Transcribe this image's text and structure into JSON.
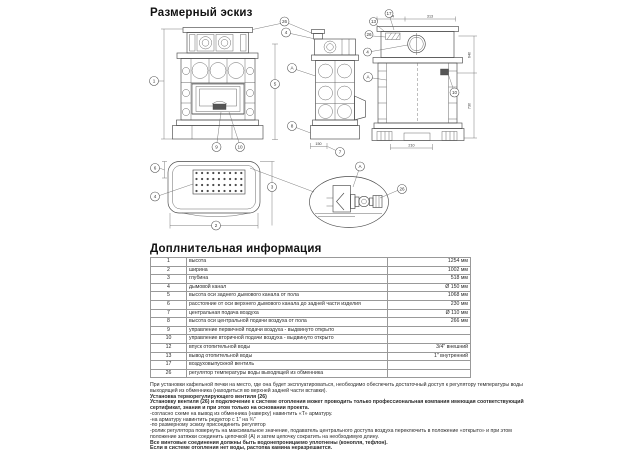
{
  "doc": {
    "drawing_title": "Размерный эскиз",
    "info_title": "Доплнительная информация"
  },
  "drawing": {
    "callouts": {
      "n1": "1",
      "n2": "2",
      "n3": "3",
      "n4": "4",
      "n5": "5",
      "n6": "6",
      "n7": "7",
      "n8": "8",
      "n9": "9",
      "n10": "10",
      "n13": "13",
      "n17": "17",
      "n26": "26",
      "a": "А"
    },
    "dimensions": {
      "rear_top_left": "204",
      "rear_top_right": "313",
      "rear_right_upper": "640",
      "rear_right_lower": "730",
      "side_bottom": "150",
      "rear_bottom": "210"
    }
  },
  "table": {
    "rows": [
      {
        "num": "1",
        "label": "высота",
        "value": "1254 мм"
      },
      {
        "num": "2",
        "label": "ширина",
        "value": "1002 мм"
      },
      {
        "num": "3",
        "label": "глубина",
        "value": "518 мм"
      },
      {
        "num": "4",
        "label": "дымовой канал",
        "value": "Ø 150 мм"
      },
      {
        "num": "5",
        "label": "высота оси заднего дымового канала от пола",
        "value": "1068 мм"
      },
      {
        "num": "6",
        "label": "расстояние от оси верхнего дымового канала до задней части изделия",
        "value": "230 мм"
      },
      {
        "num": "7",
        "label": "центральная подача воздуха",
        "value": "Ø 110 мм"
      },
      {
        "num": "8",
        "label": "высота оси центральной подачи воздуха от пола",
        "value": "266 мм"
      },
      {
        "num": "9",
        "label": "управление первичной подачи воздуха - выдвинуто открыто",
        "value": ""
      },
      {
        "num": "10",
        "label": "управление вторичной подачи воздуха - выдвинуто открыто",
        "value": ""
      },
      {
        "num": "12",
        "label": "впуск отопительной воды",
        "value": "3/4\" внешний"
      },
      {
        "num": "13",
        "label": "вывод отопительной воды",
        "value": "1\" внутренний"
      },
      {
        "num": "17",
        "label": "воздуховыпускной вентиль",
        "value": ""
      },
      {
        "num": "26",
        "label": "регулятор температуры воды выходящей из обменника",
        "value": ""
      }
    ]
  },
  "notes": {
    "lines": [
      {
        "text": "При установки кафельной печки на место, где она будет эксплуатироваться, необходимо обеспечить достаточный доступ к регулятору температуры воды",
        "bold": false
      },
      {
        "text": "выходящей из обменника (находиться во верхней задней части вставки).",
        "bold": false
      },
      {
        "text": "Установка терморегулирующего вентиля (26)",
        "bold": true
      },
      {
        "text": "Установку вентиля (26) и подключение к системе отопления может проводить только профессиональная компания имеющая соответствующий",
        "bold": true
      },
      {
        "text": "сертификат, знания и при этом только на основании проекта.",
        "bold": true
      },
      {
        "text": "-согласно схеме на вывод из обменника (наверху) навинтить «Т» арматуру.",
        "bold": false
      },
      {
        "text": "-на арматуру навинтить редуктор с 1\" на ¾\"",
        "bold": false
      },
      {
        "text": "-по размерному эскизу присоединить регулятор",
        "bold": false
      },
      {
        "text": "-ролик регулятора повернуть на максимальное значение, подаватель центрального доступа воздуха переключить в положение «открыто» и при этом",
        "bold": false
      },
      {
        "text": "положение затяжки соединить цепочкой (А) и затем цепочку сократить на необходимую длину.",
        "bold": false
      },
      {
        "text": "Все винтовые соединения должны быть водонепроницаемо уплотнены (конопля, тефлон).",
        "bold": true
      },
      {
        "text": "Если в системе отопления нет воды, растопка камина неразрешается.",
        "bold": true
      }
    ]
  }
}
